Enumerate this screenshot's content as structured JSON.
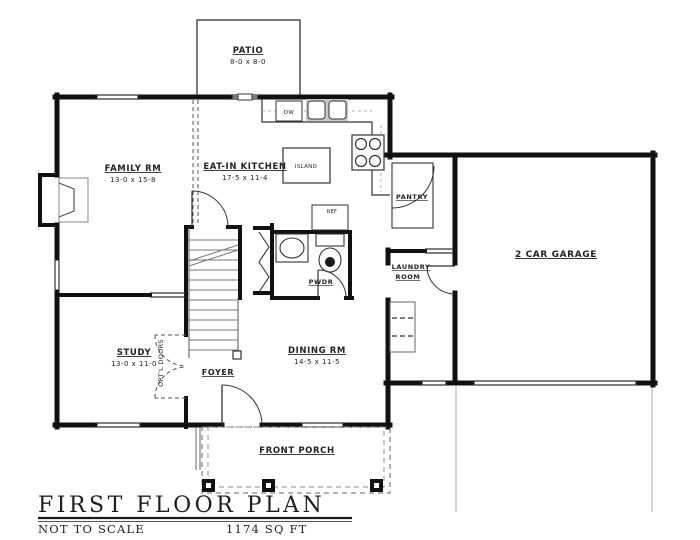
{
  "doc": {
    "title": "FIRST FLOOR PLAN",
    "scale_note": "NOT TO SCALE",
    "area": "1174 SQ FT"
  },
  "rooms": {
    "patio": {
      "name": "PATIO",
      "dims": "8-0 x 8-0"
    },
    "family": {
      "name": "FAMILY RM",
      "dims": "13-0 x 15-8"
    },
    "kitchen": {
      "name": "EAT-IN KITCHEN",
      "dims": "17-5 x 11-4"
    },
    "island": {
      "name": "ISLAND"
    },
    "pantry": {
      "name": "PANTRY"
    },
    "garage": {
      "name": "2 CAR GARAGE"
    },
    "laundry": {
      "line1": "LAUNDRY",
      "line2": "ROOM"
    },
    "powder": {
      "name": "PWDR"
    },
    "study": {
      "name": "STUDY",
      "dims": "13-0 x 11-0"
    },
    "foyer": {
      "name": "FOYER"
    },
    "dining": {
      "name": "DINING RM",
      "dims": "14-5 x 11-5"
    },
    "porch": {
      "name": "FRONT PORCH"
    }
  },
  "annotations": {
    "optl_doors": "OPT'L DOORS",
    "dishwasher": "DW",
    "refrigerator": "REF"
  },
  "colors": {
    "wall": "#111111",
    "thin_line": "#333333",
    "light_line": "#888888",
    "text": "#222222"
  }
}
